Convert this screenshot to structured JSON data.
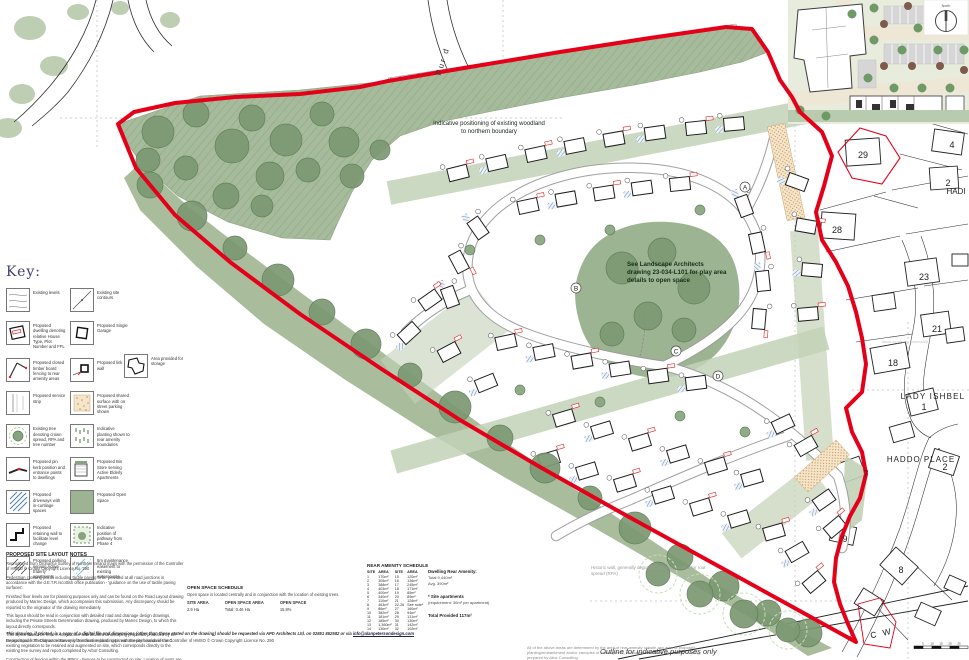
{
  "page": {
    "background": "#ffffff",
    "boundary_red": "#e50019",
    "open_space_green": "#9cb492"
  },
  "key_panel": {
    "title": "Key:",
    "items": [
      {
        "label": "Existing levels"
      },
      {
        "label": "Existing site contours"
      },
      {
        "label": "Proposed dwelling denoting relative House Type, Plot Number and FFL"
      },
      {
        "label": "Proposed Single Garage"
      },
      {
        "label": "Proposed closed timber board fencing to rear amenity areas"
      },
      {
        "label": "Proposed link wall"
      },
      {
        "label": "Area provided for storage"
      },
      {
        "label": "Proposed service strip"
      },
      {
        "label": "Proposed shared surface with on street parking shown"
      },
      {
        "label": "Existing tree denoting crown spread, RPA and tree number"
      },
      {
        "label": "Indicative planting shown to rear amenity boundaries"
      },
      {
        "label": "Proposed pin kerb position and entrance points to dwellings"
      },
      {
        "label": "Proposed Bin Store serving Active Elderly Apartments"
      },
      {
        "label": "Proposed driveways with in-curtilage spaces"
      },
      {
        "label": "Proposed Open Space"
      },
      {
        "label": "Proposed retaining wall to facilitate level change"
      },
      {
        "label": "Indicative position of pathway from Phase 4"
      },
      {
        "label": "Proposed parking serving Active Elderly apartments"
      },
      {
        "label": "5m maintenance easement to existing watercourse"
      }
    ]
  },
  "annotations": {
    "woodland_note": "Indicative positioning of existing woodland to northern boundary",
    "landscape_note": "See Landscape Architects drawing 23-034-L101 for play area details to open space",
    "historic_wall_note": "Historic wall, generally degraded, allowing access for root spread (RPA)",
    "outline_note": "Outline for indicative purposes only",
    "ownership_note": "lands in private ownership"
  },
  "map_labels": {
    "street_pur": "Pur d",
    "lady_ishbel": "LADY ISHBEL",
    "haddo_place": "HADDO PLACE",
    "hadi": "HADI",
    "cw": "C W",
    "north": "North",
    "house_numbers": [
      "29",
      "4",
      "2",
      "28",
      "23",
      "21",
      "18",
      "1",
      "2",
      "7",
      "9",
      "8"
    ],
    "road_markers": [
      "A",
      "B",
      "C",
      "D"
    ],
    "scale_ticks": [
      "5",
      "10",
      "15",
      "20",
      "25"
    ]
  },
  "notes": {
    "title": "PROPOSED SITE LAYOUT NOTES",
    "paragraphs": [
      "Reproduced from Ordnance Survey of Northern Ireland maps with the permission of the Controller of HMSO © Crown Copyright Licence No. 290",
      "Pedestrian crossing points including tactile paving to be provided at all road junctions in accordance with the d.E.T.R./scottish office publication - 'guidance on the use of tactile paving surfaces'.",
      "Finished floor levels are for planning purposes only and can be found on the Road Layout drawing produced by Marrec Design, which accompanies this submission. Any discrepancy should be reported to the originator of the drawing immediately.",
      "This layout should be read in conjunction with detailed road and drainage design drawings, including the Private Streets Determination drawing, produced by Marrec Design, to which this layout directly corresponds.",
      "This layout should be read in conjunction with detailed landscaping proposals produced by LK Design Space. This layout relates only to indicative planting to rear amenity boundaries and existing vegetation to be retained and augmented on site, which corresponds directly to the existing tree survey and report completed by Arbor Consulting.",
      "Construction of fencing within the RPA's - Fences to be constructed on site. Location of posts are to be determined on site to avoid tree roots. All excavations within the RPA'S are to be hand dug to avoid damage to tree roots."
    ],
    "footer_disclaimer": "This drawing, if printed, is a copy of a digital file and dimensions (other than those stated on the drawing) should be requested via APD Architects Ltd. on 02851 852582 or via",
    "footer_email": "info@alanpetersondesign.com",
    "footer_copyright": "Reproduced from Ordnance Survey of Northern Ireland maps with the permission of the Controller of HMSO © Crown Copyright Licence No. 290"
  },
  "open_space_schedule": {
    "title": "OPEN SPACE SCHEDULE",
    "description": "Open space is located centrally and in conjunction with the location of existing trees.",
    "columns": [
      {
        "label": "SITE AREA",
        "value": "2.9 Ha"
      },
      {
        "label": "OPEN SPACE AREA",
        "value": "Total: 0.46 Ha"
      },
      {
        "label": "OPEN SPACE",
        "value": "15.8%"
      }
    ]
  },
  "rear_amenity_schedule": {
    "title": "REAR AMENITY SCHEDULE",
    "headers": [
      "SITE",
      "AREA",
      "SITE",
      "AREA"
    ],
    "rows": [
      [
        "1",
        "170m²",
        "15",
        "120m²"
      ],
      [
        "2",
        "305m²",
        "16",
        "136m²"
      ],
      [
        "3",
        "388m²",
        "17",
        "245m²"
      ],
      [
        "4",
        "403m²",
        "18",
        "171m²"
      ],
      [
        "5",
        "400m²",
        "19",
        "85m²"
      ],
      [
        "6",
        "340m²",
        "20",
        "89m²"
      ],
      [
        "7",
        "110m²",
        "21",
        "126m²"
      ],
      [
        "8",
        "463m²",
        "22-26",
        "See note*"
      ],
      [
        "9",
        "86m²",
        "27",
        "160m²"
      ],
      [
        "10",
        "382m²",
        "28",
        "94m²"
      ],
      [
        "11",
        "181m²",
        "29",
        "131m²"
      ],
      [
        "12",
        "185m²",
        "30",
        "130m²"
      ],
      [
        "13",
        "1,360m²",
        "31",
        "142m²"
      ],
      [
        "14",
        "130m²",
        "32",
        "102m²"
      ]
    ],
    "summary_title": "Dwelling Rear Amenity:",
    "summary_lines": [
      "Total 9,440m²",
      "Avg. 390m²"
    ],
    "apartments_note_title": "* Site apartments",
    "apartments_note": "(requirement: 30m² per apartment)",
    "total_provided": "Total Provided 117m²"
  },
  "areas_note": "All of the above areas are determined by the area of rear amenity outwith any area of proposed planting/embankment and/or canopies of existing trees, as outlined within the tree survey drawing prepared by Abor Consulting."
}
